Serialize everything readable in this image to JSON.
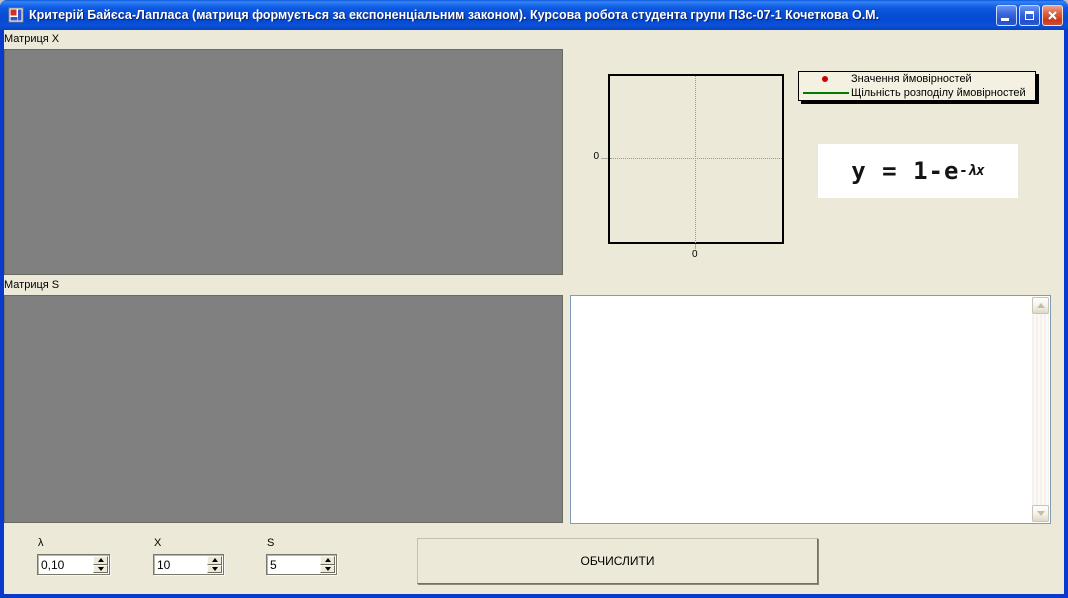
{
  "window": {
    "title": "Критерій Байєса-Лапласа (матриця формується за експоненціальним законом). Курсова робота студента групи ПЗс-07-1 Кочеткова О.М."
  },
  "labels": {
    "matrix_x": "Матриця X",
    "matrix_s": "Матриця S"
  },
  "chart": {
    "y_zero": "0",
    "x_zero": "0"
  },
  "legend": {
    "items": [
      {
        "label": "Значення ймовірностей",
        "marker": "red-dot",
        "color": "#cc0000"
      },
      {
        "label": "Щільність розподілу ймовірностей",
        "marker": "green-line",
        "color": "#007a00"
      }
    ]
  },
  "formula": {
    "base": "y = 1-e",
    "exponent": "-λx"
  },
  "output": {
    "value": ""
  },
  "inputs": {
    "lambda": {
      "label": "λ",
      "value": "0,10"
    },
    "x": {
      "label": "X",
      "value": "10"
    },
    "s": {
      "label": "S",
      "value": "5"
    }
  },
  "buttons": {
    "compute": "ОБЧИСЛИТИ"
  },
  "colors": {
    "titlebar_blue": "#0855dd",
    "window_border": "#0a3acc",
    "client_bg": "#ece9d8",
    "panel_gray": "#808080"
  }
}
